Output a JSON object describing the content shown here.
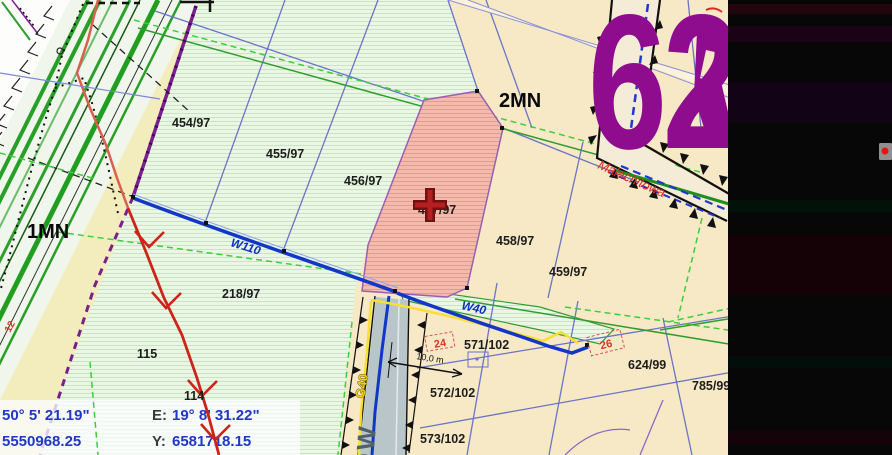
{
  "map_view": {
    "sheet_number": "62",
    "zone_labels": [
      {
        "label": "1MN"
      },
      {
        "label": "2MN"
      }
    ],
    "street_label": "Małachitowa",
    "road_class_label": "DW",
    "parcel_labels": [
      {
        "label": "454/97"
      },
      {
        "label": "455/97"
      },
      {
        "label": "456/97"
      },
      {
        "label": "457/97"
      },
      {
        "label": "458/97"
      },
      {
        "label": "459/97"
      },
      {
        "label": "218/97"
      },
      {
        "label": "115"
      },
      {
        "label": "114"
      },
      {
        "label": "571/102"
      },
      {
        "label": "572/102"
      },
      {
        "label": "573/102"
      },
      {
        "label": "624/99"
      },
      {
        "label": "785/99"
      }
    ],
    "house_number_labels": [
      {
        "label": "12"
      },
      {
        "label": "24"
      },
      {
        "label": "26"
      }
    ],
    "utility_labels": [
      {
        "label": "W110"
      },
      {
        "label": "W40"
      },
      {
        "label": "G40"
      }
    ],
    "dimension_label": "10,0 m",
    "selected_parcel": "457/97",
    "icons": {
      "selected_parcel_marker": "red-cross-marker-icon",
      "edge_control": "red-dot-icon"
    },
    "colors": {
      "selected_parcel_fill": "#f0b9ac",
      "zone_boundary_purple": "#7a1f8f",
      "water_line_blue": "#1236c8",
      "gas_line_yellow": "#f2cf1a",
      "sheet_number_purple": "#900c8e",
      "street_name_red": "#e0281e",
      "coordinate_text_blue": "#2038c8"
    }
  },
  "coordinate_panel": {
    "row1": {
      "left_value": "50° 5' 21.19\"",
      "mid_label": "E:",
      "mid_value": "19° 8' 31.22\""
    },
    "row2": {
      "left_value": "5550968.25",
      "mid_label": "Y:",
      "mid_value": "6581718.15"
    }
  }
}
